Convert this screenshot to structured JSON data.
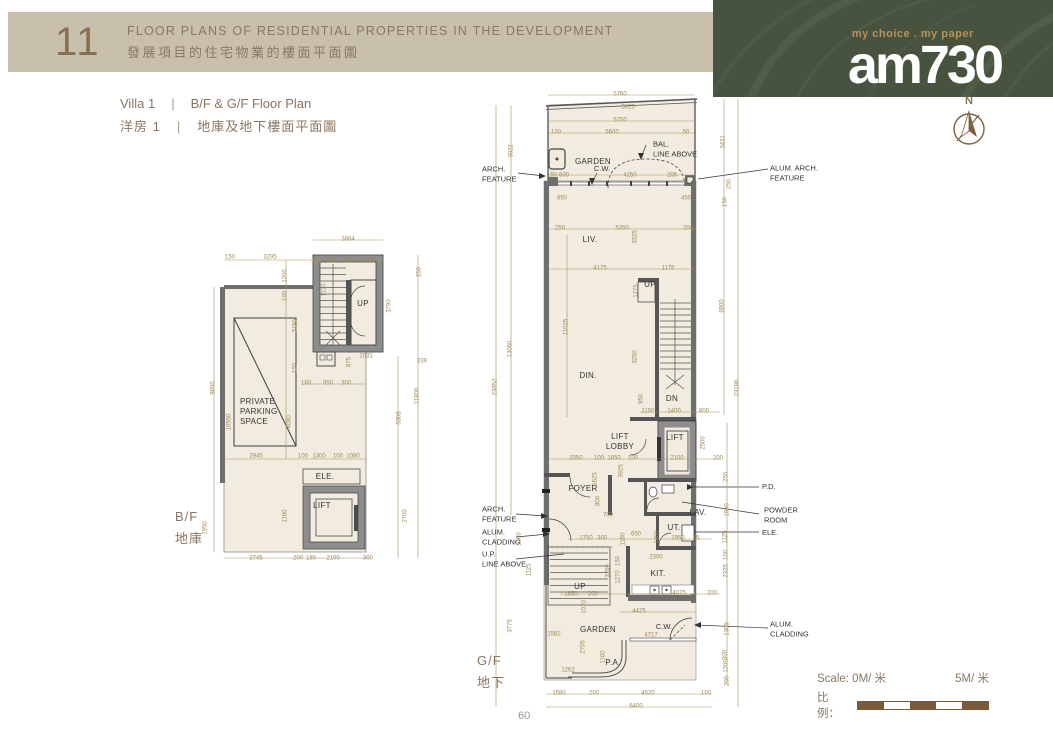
{
  "header": {
    "number": "11",
    "title_en": "FLOOR PLANS OF RESIDENTIAL PROPERTIES IN THE DEVELOPMENT",
    "title_zh": "發展項目的住宅物業的樓面平面圖"
  },
  "masthead": {
    "tagline": "my choice . my paper",
    "brand": "am730"
  },
  "compass": {
    "label": "N"
  },
  "subtitle": {
    "villa_en": "Villa 1",
    "sep": "|",
    "plan_en": "B/F & G/F Floor Plan",
    "villa_zh": "洋房 1",
    "plan_zh": "地庫及地下樓面平面圖"
  },
  "floors": {
    "bf_en": "B/F",
    "bf_zh": "地庫",
    "gf_en": "G/F",
    "gf_zh": "地下"
  },
  "scale_bar": {
    "prefix_en": "Scale:",
    "start": "0M/ 米",
    "end": "5M/ 米",
    "prefix_zh": "比例："
  },
  "page_number": "60",
  "colors": {
    "band": "#c9c0ab",
    "banner_green": "#47523f",
    "accent_brown": "#8a6e52",
    "dim_gold": "#a6925e",
    "plan_fill": "#f1ecdf",
    "wall_gray": "#8d8d8d",
    "scale_brown": "#7a5a3a"
  },
  "plans": {
    "bf": {
      "texts": [
        {
          "t": "3884",
          "x": 178,
          "y": 14
        },
        {
          "t": "150",
          "x": 60,
          "y": 32
        },
        {
          "t": "3295",
          "x": 100,
          "y": 32
        },
        {
          "t": "180",
          "x": 146,
          "y": 36
        },
        {
          "t": "950",
          "x": 162,
          "y": 36
        },
        {
          "t": "300",
          "x": 178,
          "y": 36
        },
        {
          "t": "1066",
          "x": 198,
          "y": 36
        },
        {
          "t": "1130",
          "x": 155,
          "y": 64,
          "r": 1
        },
        {
          "t": "250",
          "x": 250,
          "y": 46,
          "r": 1
        },
        {
          "t": "3790",
          "x": 220,
          "y": 80,
          "r": 1
        },
        {
          "t": "1200",
          "x": 116,
          "y": 50,
          "r": 1
        },
        {
          "t": "100",
          "x": 116,
          "y": 70,
          "r": 1
        },
        {
          "t": "3190",
          "x": 126,
          "y": 100,
          "r": 1
        },
        {
          "t": "150",
          "x": 126,
          "y": 142,
          "r": 1
        },
        {
          "t": "UP",
          "x": 193,
          "y": 78,
          "c": "room"
        },
        {
          "t": "1031",
          "x": 196,
          "y": 131
        },
        {
          "t": "239",
          "x": 252,
          "y": 136
        },
        {
          "t": "875",
          "x": 180,
          "y": 136,
          "r": 1
        },
        {
          "t": "180",
          "x": 136,
          "y": 158
        },
        {
          "t": "950",
          "x": 158,
          "y": 158
        },
        {
          "t": "300",
          "x": 176,
          "y": 158
        },
        {
          "t": "8650",
          "x": 44,
          "y": 162,
          "r": 1
        },
        {
          "t": "11800",
          "x": 248,
          "y": 170,
          "r": 1
        },
        {
          "t": "5308",
          "x": 230,
          "y": 192,
          "r": 1
        },
        {
          "t": "10550",
          "x": 60,
          "y": 196,
          "r": 1
        },
        {
          "t": "4080",
          "x": 120,
          "y": 196,
          "r": 1
        },
        {
          "t": "PRIVATE\nPARKING\nSPACE",
          "x": 70,
          "y": 186,
          "c": "room",
          "a": "l"
        },
        {
          "t": "2945",
          "x": 86,
          "y": 231
        },
        {
          "t": "100",
          "x": 133,
          "y": 231
        },
        {
          "t": "1300",
          "x": 149,
          "y": 231
        },
        {
          "t": "100",
          "x": 168,
          "y": 231
        },
        {
          "t": "1080",
          "x": 183,
          "y": 231
        },
        {
          "t": "ELE.",
          "x": 155,
          "y": 251,
          "c": "room"
        },
        {
          "t": "LIFT",
          "x": 152,
          "y": 280,
          "c": "room"
        },
        {
          "t": "1950",
          "x": 36,
          "y": 302,
          "r": 1
        },
        {
          "t": "1160",
          "x": 116,
          "y": 290,
          "r": 1
        },
        {
          "t": "2700",
          "x": 236,
          "y": 290,
          "r": 1
        },
        {
          "t": "2745",
          "x": 86,
          "y": 333
        },
        {
          "t": "200",
          "x": 128,
          "y": 333
        },
        {
          "t": "180",
          "x": 141,
          "y": 333
        },
        {
          "t": "2100",
          "x": 163,
          "y": 333
        },
        {
          "t": "300",
          "x": 198,
          "y": 333
        }
      ]
    },
    "gf": {
      "texts": [
        {
          "t": "5760",
          "x": 140,
          "y": 10
        },
        {
          "t": "5625",
          "x": 148,
          "y": 23
        },
        {
          "t": "5750",
          "x": 140,
          "y": 36
        },
        {
          "t": "100",
          "x": 76,
          "y": 48
        },
        {
          "t": "5600",
          "x": 132,
          "y": 48
        },
        {
          "t": "50",
          "x": 206,
          "y": 48
        },
        {
          "t": "GARDEN",
          "x": 113,
          "y": 77,
          "c": "room"
        },
        {
          "t": "BAL.\nLINE ABOVE",
          "x": 173,
          "y": 64,
          "c": "ann",
          "a": "l"
        },
        {
          "t": "C.W.",
          "x": 122,
          "y": 84,
          "c": "ann"
        },
        {
          "t": "ARCH.\nFEATURE",
          "x": 2,
          "y": 89,
          "c": "ann",
          "a": "l"
        },
        {
          "t": "ALUM. ARCH.\nFEATURE",
          "x": 290,
          "y": 88,
          "c": "ann",
          "a": "l"
        },
        {
          "t": "150",
          "x": 72,
          "y": 91
        },
        {
          "t": "600",
          "x": 84,
          "y": 91
        },
        {
          "t": "4250",
          "x": 150,
          "y": 91
        },
        {
          "t": "205",
          "x": 192,
          "y": 91
        },
        {
          "t": "3022",
          "x": 32,
          "y": 66,
          "r": 1
        },
        {
          "t": "3431",
          "x": 244,
          "y": 57,
          "r": 1
        },
        {
          "t": "250",
          "x": 250,
          "y": 99,
          "r": 1
        },
        {
          "t": "150",
          "x": 246,
          "y": 117,
          "r": 1
        },
        {
          "t": "650",
          "x": 82,
          "y": 114
        },
        {
          "t": "450",
          "x": 206,
          "y": 114
        },
        {
          "t": "250",
          "x": 80,
          "y": 144
        },
        {
          "t": "5350",
          "x": 142,
          "y": 144
        },
        {
          "t": "200",
          "x": 208,
          "y": 144
        },
        {
          "t": "LIV.",
          "x": 110,
          "y": 155,
          "c": "room"
        },
        {
          "t": "3325",
          "x": 156,
          "y": 152,
          "r": 1
        },
        {
          "t": "4175",
          "x": 120,
          "y": 184
        },
        {
          "t": "1175",
          "x": 188,
          "y": 184
        },
        {
          "t": "UP",
          "x": 170,
          "y": 200,
          "c": "room"
        },
        {
          "t": "1275",
          "x": 157,
          "y": 206,
          "r": 1
        },
        {
          "t": "11025",
          "x": 87,
          "y": 242,
          "r": 1
        },
        {
          "t": "13050",
          "x": 31,
          "y": 264,
          "r": 1
        },
        {
          "t": "23852",
          "x": 16,
          "y": 302,
          "r": 1
        },
        {
          "t": "8800",
          "x": 243,
          "y": 221,
          "r": 1
        },
        {
          "t": "23186",
          "x": 258,
          "y": 303,
          "r": 1
        },
        {
          "t": "DIN.",
          "x": 108,
          "y": 291,
          "c": "room"
        },
        {
          "t": "3250",
          "x": 156,
          "y": 272,
          "r": 1
        },
        {
          "t": "DN",
          "x": 192,
          "y": 314,
          "c": "room"
        },
        {
          "t": "950",
          "x": 162,
          "y": 314,
          "r": 1
        },
        {
          "t": "1150",
          "x": 168,
          "y": 327
        },
        {
          "t": "1400",
          "x": 194,
          "y": 327
        },
        {
          "t": "800",
          "x": 224,
          "y": 327
        },
        {
          "t": "LIFT\nLOBBY",
          "x": 140,
          "y": 357,
          "c": "room"
        },
        {
          "t": "LIFT",
          "x": 195,
          "y": 353,
          "c": "room"
        },
        {
          "t": "2100",
          "x": 197,
          "y": 374
        },
        {
          "t": "2500",
          "x": 224,
          "y": 358,
          "r": 1
        },
        {
          "t": "2050",
          "x": 96,
          "y": 374
        },
        {
          "t": "100",
          "x": 119,
          "y": 374
        },
        {
          "t": "1850",
          "x": 134,
          "y": 374
        },
        {
          "t": "100",
          "x": 153,
          "y": 374
        },
        {
          "t": "200",
          "x": 238,
          "y": 374
        },
        {
          "t": "3925",
          "x": 142,
          "y": 386,
          "r": 1
        },
        {
          "t": "FOYER",
          "x": 103,
          "y": 404,
          "c": "room"
        },
        {
          "t": "1625",
          "x": 116,
          "y": 394,
          "r": 1
        },
        {
          "t": "800",
          "x": 119,
          "y": 416,
          "r": 1
        },
        {
          "t": "250",
          "x": 247,
          "y": 392,
          "r": 1
        },
        {
          "t": "P.D.",
          "x": 282,
          "y": 402,
          "c": "ann",
          "a": "l"
        },
        {
          "t": "POWDER\nROOM",
          "x": 284,
          "y": 430,
          "c": "ann",
          "a": "l"
        },
        {
          "t": "ELE.",
          "x": 282,
          "y": 448,
          "c": "ann",
          "a": "l"
        },
        {
          "t": "LAV.",
          "x": 218,
          "y": 428,
          "c": "room"
        },
        {
          "t": "UT.",
          "x": 194,
          "y": 443,
          "c": "room"
        },
        {
          "t": "75",
          "x": 216,
          "y": 454
        },
        {
          "t": "1950",
          "x": 198,
          "y": 454
        },
        {
          "t": "1300",
          "x": 178,
          "y": 452,
          "r": 1
        },
        {
          "t": "650",
          "x": 156,
          "y": 450
        },
        {
          "t": "700",
          "x": 128,
          "y": 431
        },
        {
          "t": "1750",
          "x": 106,
          "y": 454
        },
        {
          "t": "300",
          "x": 122,
          "y": 454
        },
        {
          "t": "1160",
          "x": 144,
          "y": 454,
          "r": 1
        },
        {
          "t": "1900",
          "x": 248,
          "y": 425,
          "r": 1
        },
        {
          "t": "1125",
          "x": 246,
          "y": 452,
          "r": 1
        },
        {
          "t": "100",
          "x": 247,
          "y": 470,
          "r": 1
        },
        {
          "t": "2325",
          "x": 247,
          "y": 486,
          "r": 1
        },
        {
          "t": "ARCH.\nFEATURE",
          "x": 2,
          "y": 429,
          "c": "ann",
          "a": "l"
        },
        {
          "t": "ALUM.\nCLADDING",
          "x": 2,
          "y": 452,
          "c": "ann",
          "a": "l"
        },
        {
          "t": "U.P.\nLINE ABOVE",
          "x": 2,
          "y": 474,
          "c": "ann",
          "a": "l"
        },
        {
          "t": "1360",
          "x": 40,
          "y": 454,
          "r": 1
        },
        {
          "t": "1125",
          "x": 50,
          "y": 485,
          "r": 1
        },
        {
          "t": "KIT.",
          "x": 178,
          "y": 489,
          "c": "room"
        },
        {
          "t": "2300",
          "x": 176,
          "y": 473
        },
        {
          "t": "3350",
          "x": 129,
          "y": 486,
          "r": 1
        },
        {
          "t": "150",
          "x": 139,
          "y": 476,
          "r": 1
        },
        {
          "t": "1270",
          "x": 139,
          "y": 492,
          "r": 1
        },
        {
          "t": "UP",
          "x": 100,
          "y": 502,
          "c": "room"
        },
        {
          "t": "1850",
          "x": 91,
          "y": 510
        },
        {
          "t": "200",
          "x": 113,
          "y": 510
        },
        {
          "t": "1070",
          "x": 105,
          "y": 522,
          "r": 1
        },
        {
          "t": "4075",
          "x": 199,
          "y": 509
        },
        {
          "t": "200",
          "x": 232,
          "y": 509
        },
        {
          "t": "4425",
          "x": 159,
          "y": 527
        },
        {
          "t": "C.W.",
          "x": 184,
          "y": 542,
          "c": "ann"
        },
        {
          "t": "4717",
          "x": 171,
          "y": 551
        },
        {
          "t": "GARDEN",
          "x": 118,
          "y": 545,
          "c": "room"
        },
        {
          "t": "1582",
          "x": 74,
          "y": 550
        },
        {
          "t": "2705",
          "x": 104,
          "y": 562,
          "r": 1
        },
        {
          "t": "3775",
          "x": 31,
          "y": 541,
          "r": 1
        },
        {
          "t": "P.A.",
          "x": 133,
          "y": 578,
          "c": "room"
        },
        {
          "t": "1160",
          "x": 124,
          "y": 572,
          "r": 1
        },
        {
          "t": "1262",
          "x": 88,
          "y": 586
        },
        {
          "t": "ALUM.\nCLADDING",
          "x": 290,
          "y": 544,
          "c": "ann",
          "a": "l"
        },
        {
          "t": "1305",
          "x": 248,
          "y": 544,
          "r": 1
        },
        {
          "t": "300",
          "x": 246,
          "y": 570,
          "r": 1
        },
        {
          "t": "1200",
          "x": 247,
          "y": 581,
          "r": 1
        },
        {
          "t": "200",
          "x": 248,
          "y": 596,
          "r": 1
        },
        {
          "t": "1580",
          "x": 79,
          "y": 609
        },
        {
          "t": "200",
          "x": 114,
          "y": 609
        },
        {
          "t": "4520",
          "x": 168,
          "y": 609
        },
        {
          "t": "100",
          "x": 226,
          "y": 609
        },
        {
          "t": "6400",
          "x": 156,
          "y": 622
        }
      ]
    }
  }
}
